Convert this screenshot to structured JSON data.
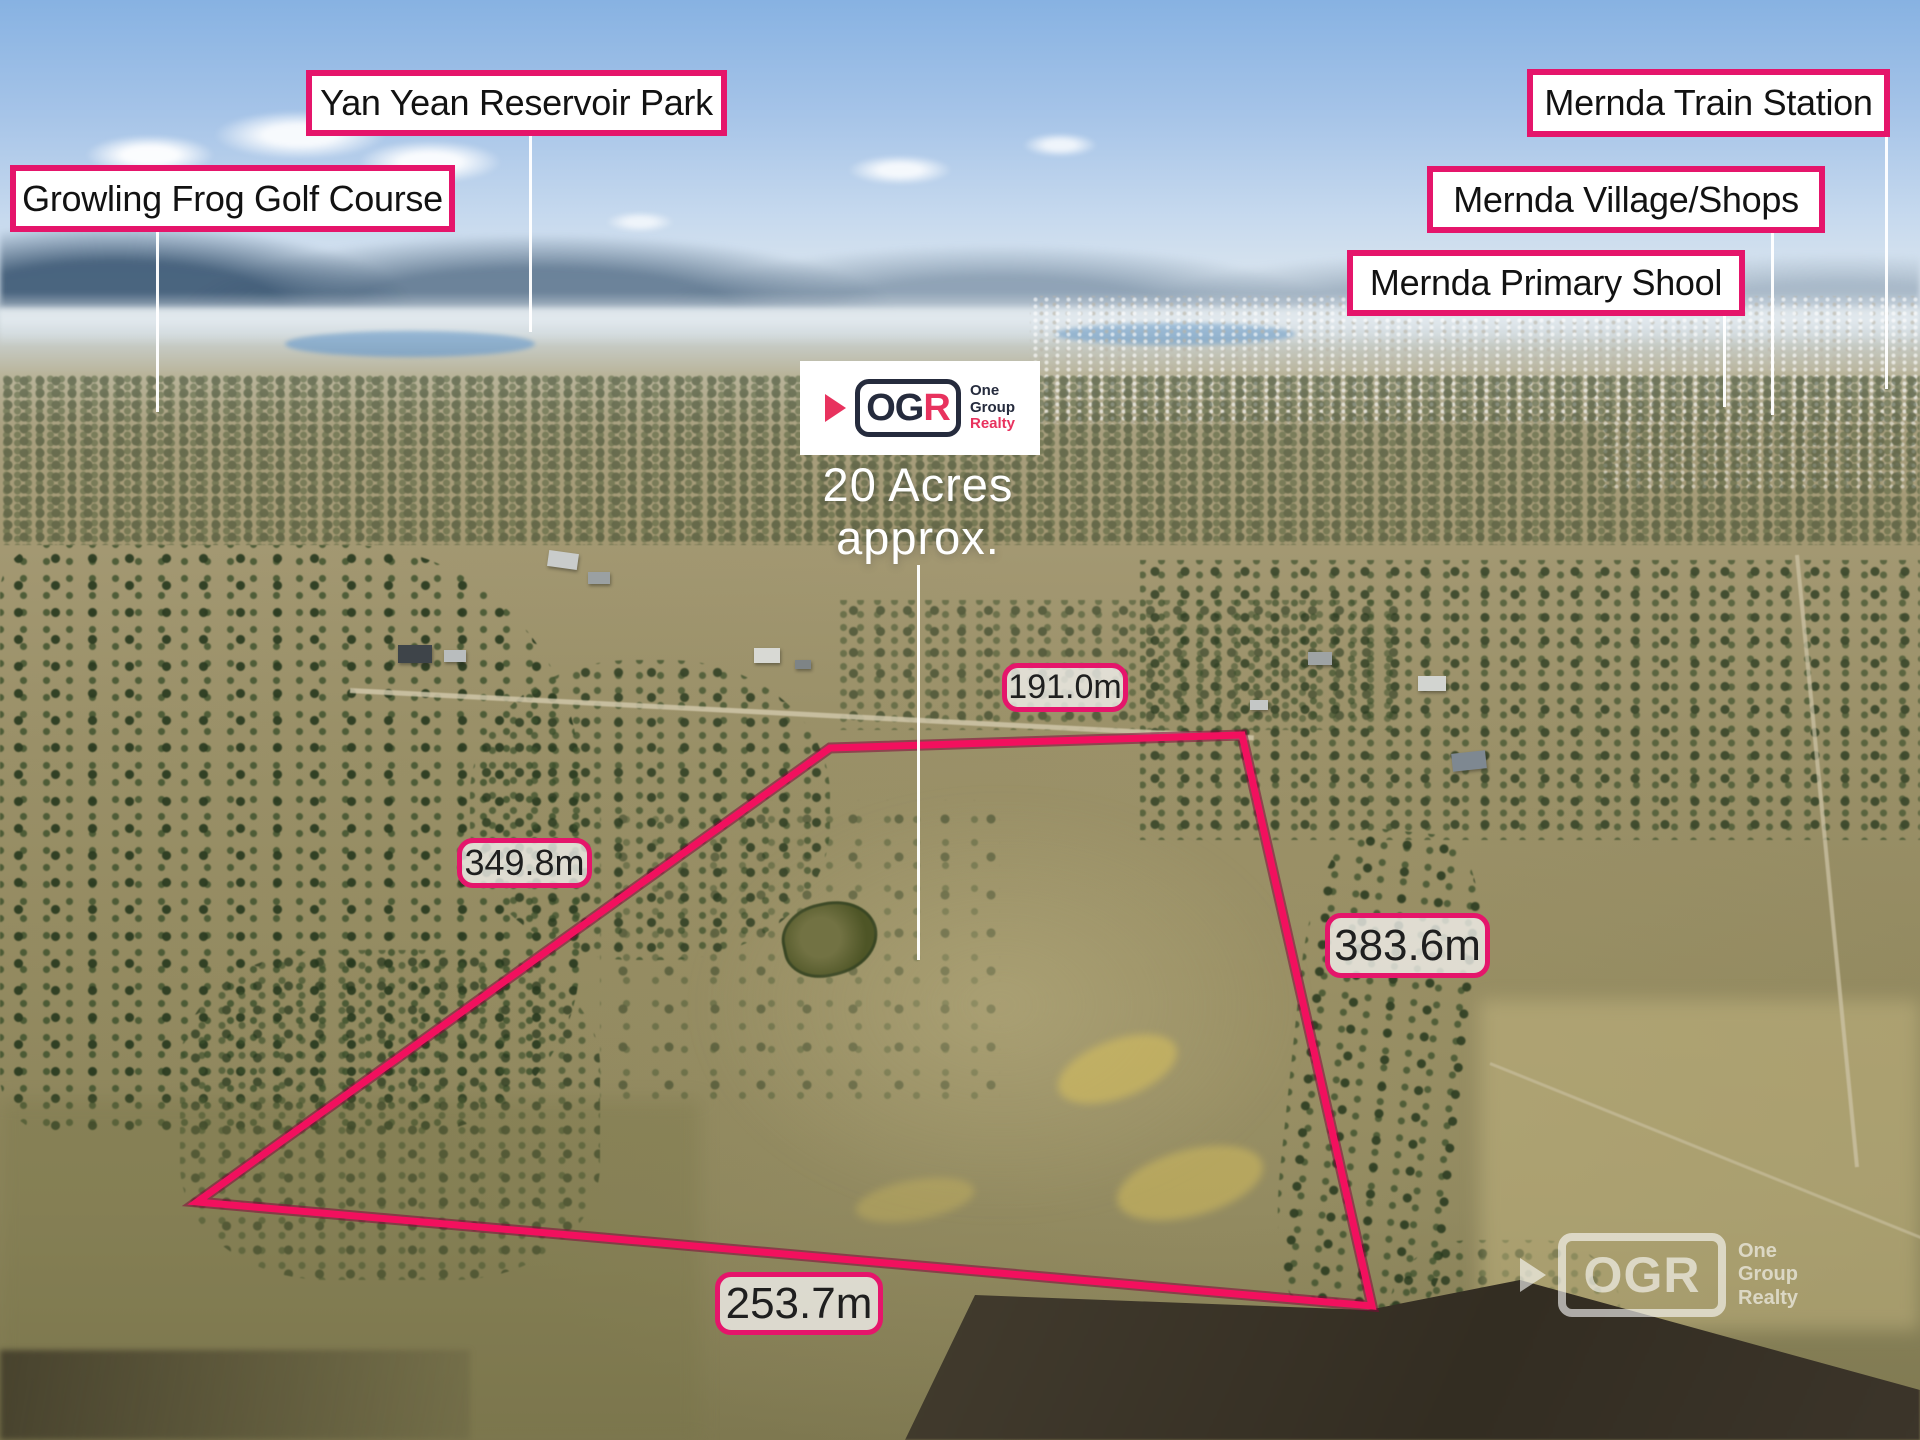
{
  "annotations": {
    "location_labels": [
      {
        "text": "Yan Yean Reservoir Park"
      },
      {
        "text": "Growling Frog Golf Course"
      },
      {
        "text": "Mernda Train Station"
      },
      {
        "text": "Mernda Village/Shops"
      },
      {
        "text": "Mernda Primary Shool"
      }
    ],
    "area": {
      "line1": "20 Acres",
      "line2": "approx."
    },
    "measurements": {
      "top": "191.0m",
      "left": "349.8m",
      "right": "383.6m",
      "bottom": "253.7m"
    }
  },
  "branding": {
    "logo": {
      "brand_og": "OG",
      "brand_r": "R",
      "tagline": [
        "One",
        "Group",
        "Realty"
      ]
    },
    "watermark": {
      "brand": "OGR",
      "tagline": [
        "One",
        "Group",
        "Realty"
      ]
    }
  },
  "boundary": {
    "points": "830,748 1242,735 1372,1306 197,1202",
    "color": "#f2105e"
  },
  "colors": {
    "label_border_pink": "#e5156b",
    "boundary_pink": "#f2105e",
    "logo_navy": "#252b3d",
    "logo_pink": "#e8325e",
    "sky_blue": "#87b2e2",
    "land_tan": "#9a9068"
  }
}
